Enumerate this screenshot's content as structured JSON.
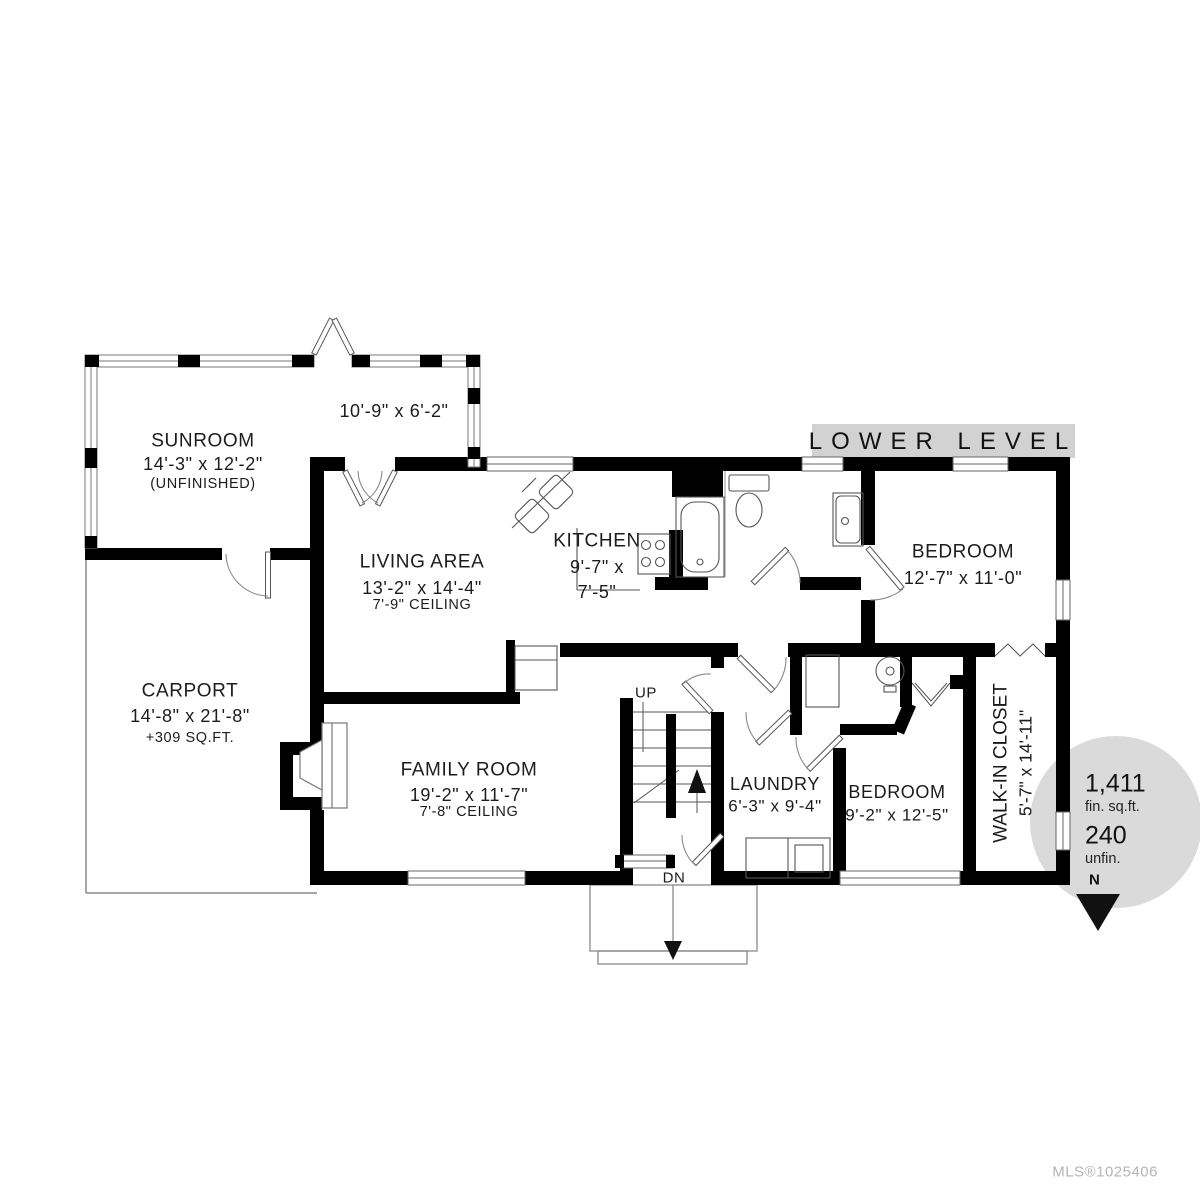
{
  "title": "LOWER LEVEL",
  "rooms": {
    "deck": {
      "dims": "10'-9\" x 6'-2\""
    },
    "sunroom": {
      "name": "SUNROOM",
      "dims": "14'-3\" x 12'-2\"",
      "note": "(UNFINISHED)"
    },
    "living": {
      "name": "LIVING AREA",
      "dims": "13'-2\" x 14'-4\"",
      "ceiling": "7'-9\" CEILING"
    },
    "kitchen": {
      "name": "KITCHEN",
      "dims_line1": "9'-7\" x",
      "dims_line2": "7'-5\""
    },
    "bedroom1": {
      "name": "BEDROOM",
      "dims": "12'-7\" x 11'-0\""
    },
    "carport": {
      "name": "CARPORT",
      "dims": "14'-8\" x 21'-8\"",
      "note": "+309 SQ.FT."
    },
    "family": {
      "name": "FAMILY ROOM",
      "dims": "19'-2\" x 11'-7\"",
      "ceiling": "7'-8\" CEILING"
    },
    "laundry": {
      "name": "LAUNDRY",
      "dims": "6'-3\" x 9'-4\""
    },
    "bedroom2": {
      "name": "BEDROOM",
      "dims": "9'-2\" x 12'-5\""
    },
    "walkin": {
      "name": "WALK-IN CLOSET",
      "dims": "5'-7\" x 14'-11\""
    }
  },
  "stairs": {
    "up": "UP",
    "down": "DN"
  },
  "area_badge": {
    "finished": "1,411",
    "finished_label": "fin. sq.ft.",
    "unfinished": "240",
    "unfinished_label": "unfin.",
    "north": "N"
  },
  "footer": {
    "mls": "MLS®1025406"
  },
  "colors": {
    "wall": "#000000",
    "banner_bg": "#d2d2d2",
    "badge_bg": "#dadada",
    "line": "#666666",
    "mls_text": "#b5b5b5"
  }
}
